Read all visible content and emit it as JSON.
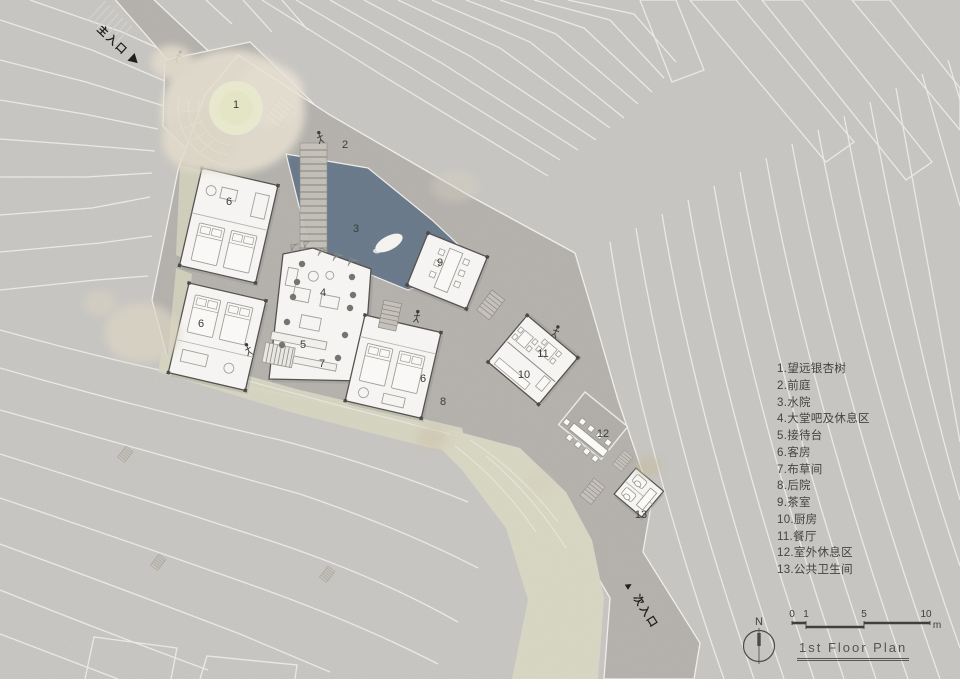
{
  "page": {
    "title": "1st Floor Plan"
  },
  "entrances": {
    "main": "主入口 ▶",
    "secondary": "▲ 次入口"
  },
  "legend": {
    "lines": [
      "1.望远银杏树",
      "2.前庭",
      "3.水院",
      "4.大堂吧及休息区",
      "5.接待台",
      "6.客房",
      "7.布草间",
      "8.后院",
      "9.茶室",
      "10.厨房",
      "11.餐厅",
      "12.室外休息区",
      "13.公共卫生间"
    ]
  },
  "plan": {
    "labels": {
      "tree": "1",
      "forecourt": "2",
      "water": "3",
      "lobby": "4",
      "reception": "5",
      "guest": "6",
      "linen": "7",
      "backyard": "8",
      "tearoom": "9",
      "kitchen": "10",
      "dining": "11",
      "outdoor": "12",
      "restroom": "13"
    }
  },
  "compass": {
    "n": "N"
  },
  "scalebar": {
    "t0": "0",
    "t1": "1",
    "t5": "5",
    "t10": "10",
    "unit": "m"
  },
  "colors": {
    "paper": "#c9c7c4",
    "road": "#b6b3af",
    "water": "#6b7b8c",
    "vegetation": "#d8d7c3",
    "tree_canopy": "#e7e1d2",
    "building": "#f8f7f5"
  }
}
